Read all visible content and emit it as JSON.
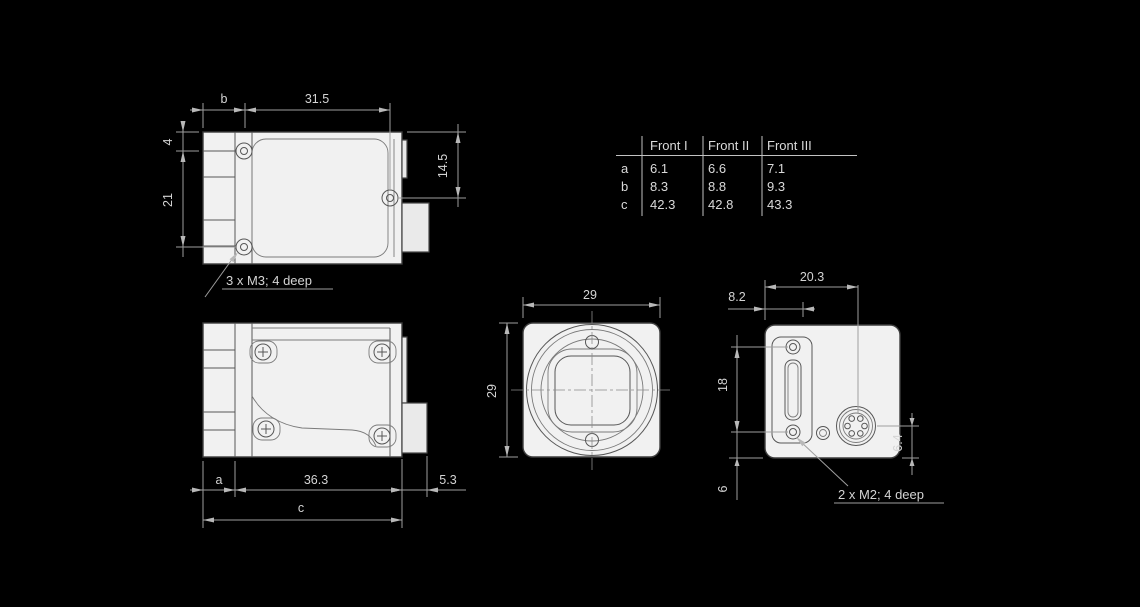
{
  "drawing_title": "camera-dimensional-drawing",
  "colors": {
    "background": "#000000",
    "body_fill": "#f1f1f1",
    "body_outline": "#3d3d3d",
    "dimension_lines": "#9e9e9e",
    "dimension_text": "#d4d4d4",
    "table_text": "#dadada"
  },
  "table": {
    "headers": [
      "Front I",
      "Front II",
      "Front III"
    ],
    "rows": [
      {
        "label": "a",
        "values": [
          "6.1",
          "6.6",
          "7.1"
        ]
      },
      {
        "label": "b",
        "values": [
          "8.3",
          "8.8",
          "9.3"
        ]
      },
      {
        "label": "c",
        "values": [
          "42.3",
          "42.8",
          "43.3"
        ]
      }
    ]
  },
  "top_view": {
    "dim_b": "b",
    "dim_31_5": "31.5",
    "dim_4": "4",
    "dim_21": "21",
    "dim_14_5": "14.5",
    "note": "3 x M3; 4 deep"
  },
  "side_view": {
    "dim_a": "a",
    "dim_36_3": "36.3",
    "dim_5_3": "5.3",
    "dim_c": "c"
  },
  "front_view": {
    "dim_width": "29",
    "dim_height": "29"
  },
  "back_view": {
    "dim_20_3": "20.3",
    "dim_8_2": "8.2",
    "dim_18": "18",
    "dim_6": "6",
    "dim_6_4": "6.4",
    "note": "2 x M2; 4 deep"
  }
}
